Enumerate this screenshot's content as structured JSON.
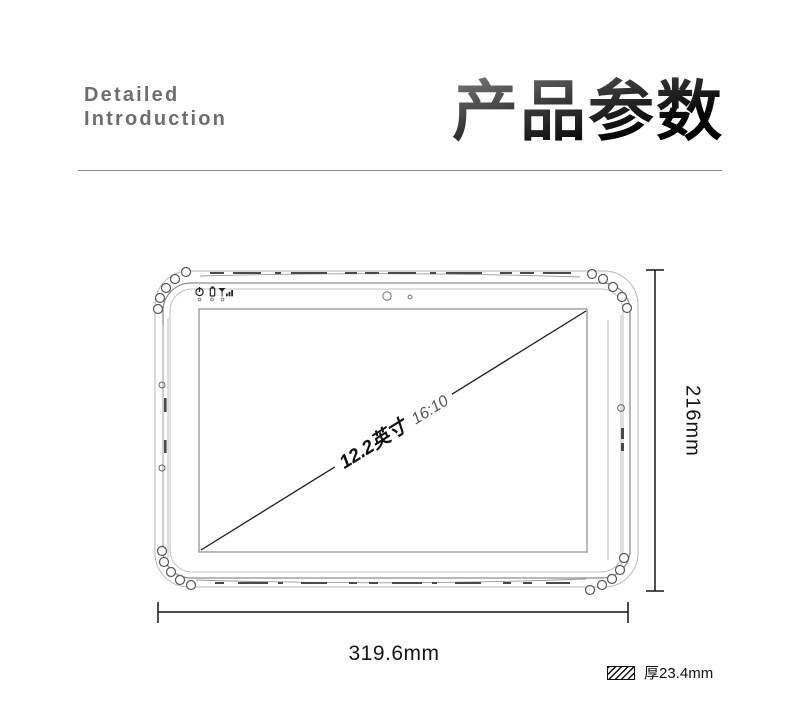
{
  "header": {
    "eyebrow": {
      "line1": "Detailed",
      "line2": "Introduction"
    },
    "title": "产品参数"
  },
  "diagram": {
    "screen_size": "12.2英寸",
    "aspect_ratio": "16:10",
    "height": "216mm",
    "width": "319.6mm",
    "thickness": "厚23.4mm",
    "status_icons": [
      "power-icon",
      "battery-icon",
      "signal-icon"
    ],
    "camera_icons": [
      "front-camera-icon",
      "light-sensor-icon"
    ],
    "thickness_icon": "hatch-swatch-icon"
  },
  "colors": {
    "title_gradient_top": "#909090",
    "title_gradient_bottom": "#000000",
    "eyebrow_text": "#6e6e6e",
    "divider": "#8a8a8a",
    "dimension_line": "#151515",
    "sketch_line": "#9a9a9a"
  }
}
